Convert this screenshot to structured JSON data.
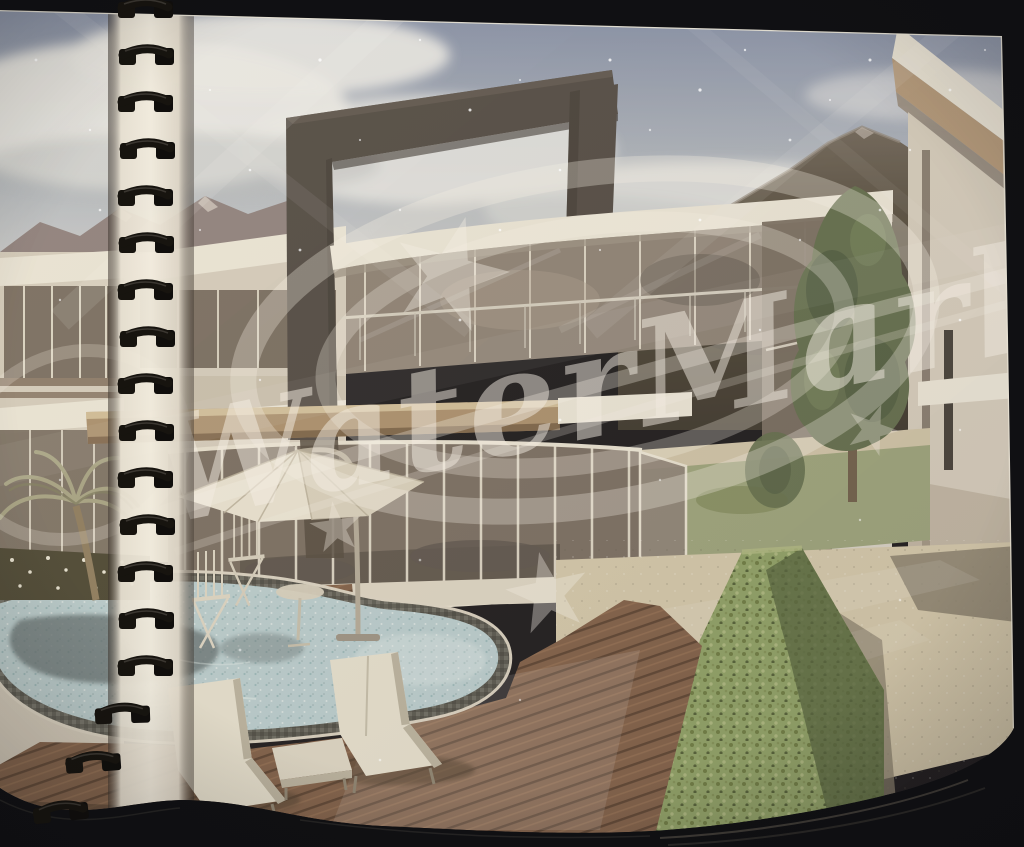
{
  "photo": {
    "subject": "spiral-bound brochure page with architectural rendering of a villa with pool",
    "watermark": {
      "text": "WaterMark",
      "star_count": 4,
      "ring_count": 2
    },
    "binding": {
      "coil_count": 18,
      "side": "left"
    },
    "scene_objects": {
      "sun_loungers": 2,
      "folding_chairs": 2,
      "umbrellas": 1,
      "palm_trees": 1,
      "pools": 1,
      "buildings": 3
    },
    "palette": {
      "bg": "#141418",
      "paper": "#e9e2d3",
      "page_edge": "#e8e2d4",
      "sky_top": "#7d8aa6",
      "sky_mid": "#aeb6bf",
      "sky_bot": "#d7d8d7",
      "cloud": "#ebecea",
      "cloud_shade": "#bcc0c2",
      "mtn": "#8c7f7e",
      "mtn_snow": "#d9d1ca",
      "mtn_center": "#908a93",
      "mtn_right": "#4e4739",
      "mtn_right_dark": "#37332a",
      "frame": "#4b4641",
      "frame_dark": "#332f2b",
      "frame_lite": "#5d5750",
      "facade": "#ece8db",
      "facade_dim": "#d5cebf",
      "facade_shadow": "#9a9184",
      "band_brown": "#a98f6d",
      "soffit": "#b29879",
      "glass_dark": "#756b60",
      "glass_mid": "#8a8075",
      "mullion": "#e8e3d3",
      "rail": "#d4cfc1",
      "stone": "#ddd7c6",
      "terrace": "#d3c9ac",
      "terrace_shadow": "#857e6b",
      "grass": "#9aa37b",
      "tree": "#5d6b4a",
      "tree_dark": "#45533a",
      "hedge": "#8ba064",
      "hedge_hi": "#aeba82",
      "hedge_dark": "#4e5f38",
      "deck": "#7c5c45",
      "deck_line": "#573f2e",
      "deck_hi": "#977253",
      "pool_rim": "#5b5c56",
      "water": "#b8ced1",
      "water_dark": "#5c6a6d",
      "water_hi": "#e4efee",
      "lounger": "#e6e2d1",
      "umbrella": "#eae5d5",
      "pole": "#b2aa99",
      "palm": "#a5a384",
      "trunk": "#8b7a5c",
      "coil": "#17140f",
      "coil_hi": "#45403a",
      "wm": "rgba(251,247,239,0.50)"
    }
  }
}
